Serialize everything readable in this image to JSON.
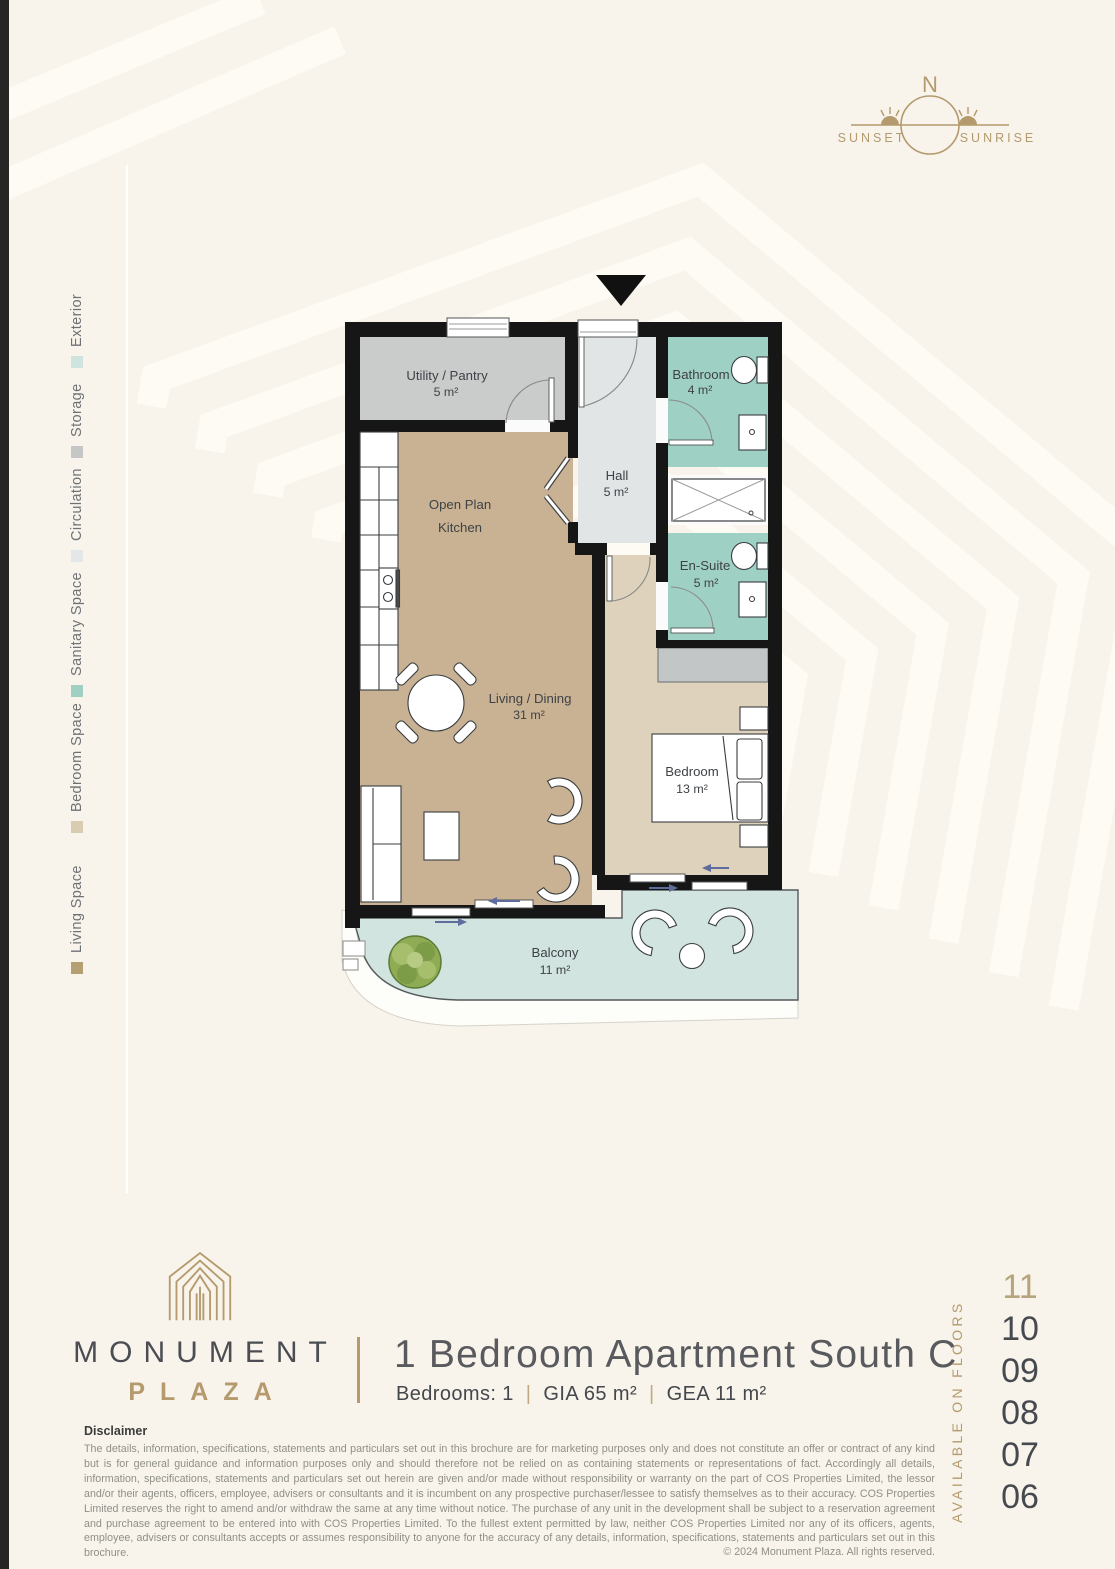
{
  "page": {
    "background": "#f8f4ec",
    "accent_gold": "#b49a6c",
    "edge_strip_color": "#262624"
  },
  "compass": {
    "north": "N",
    "sunset": "SUNSET",
    "sunrise": "SUNRISE"
  },
  "legend": {
    "items": [
      {
        "label": "Living Space",
        "color": "#b4a073"
      },
      {
        "label": "Bedroom Space",
        "color": "#d8ccb2"
      },
      {
        "label": "Sanitary Space",
        "color": "#a0cfc4"
      },
      {
        "label": "Circulation",
        "color": "#e3e7e8"
      },
      {
        "label": "Storage",
        "color": "#c5c7c6"
      },
      {
        "label": "Exterior",
        "color": "#cfe3df"
      }
    ]
  },
  "floorplan": {
    "room_fills": {
      "living": "#c9b293",
      "bedroom": "#ded2bc",
      "sanitary": "#9fd0c4",
      "circulation": "#e1e5e6",
      "storage": "#c9cccb",
      "exterior": "#d1e4e0",
      "wardrobe": "#c3c6c6",
      "shower": "#fafbfa"
    },
    "rooms": {
      "utility": {
        "name": "Utility / Pantry",
        "area": "5 m²"
      },
      "kitchen": {
        "name_line1": "Open Plan",
        "name_line2": "Kitchen"
      },
      "hall": {
        "name": "Hall",
        "area": "5 m²"
      },
      "bathroom": {
        "name": "Bathroom",
        "area": "4 m²"
      },
      "ensuite": {
        "name": "En-Suite",
        "area": "5 m²"
      },
      "living": {
        "name": "Living / Dining",
        "area": "31 m²"
      },
      "bedroom": {
        "name": "Bedroom",
        "area": "13 m²"
      },
      "balcony": {
        "name": "Balcony",
        "area": "11 m²"
      }
    }
  },
  "footer": {
    "brand": {
      "line1": "MONUMENT",
      "line2": "PLAZA"
    },
    "unit_title": "1 Bedroom Apartment South C",
    "specs": {
      "bedrooms": "Bedrooms: 1",
      "gia": "GIA 65 m²",
      "gea": "GEA 11 m²",
      "separator": "|"
    },
    "availability": {
      "label": "AVAILABLE ON FLOORS",
      "floors": [
        "11",
        "10",
        "09",
        "08",
        "07",
        "06"
      ],
      "highlighted_floor": "11"
    },
    "disclaimer": {
      "title": "Disclaimer",
      "body": "The details, information, specifications, statements and particulars set out in this brochure are for marketing purposes only and does not constitute an offer or contract of any kind but is for general guidance and information purposes only and should therefore not be relied on as containing statements or representations of fact. Accordingly all details, information, specifications, statements and particulars set out herein are given and/or made without responsibility or warranty on the part of COS Properties Limited, the lessor and/or their agents, officers, employee, advisers or consultants and it is incumbent on any prospective purchaser/lessee to satisfy themselves as to their accuracy. COS Properties Limited reserves the right to amend and/or withdraw the same at any time without notice. The purchase of any unit in the development shall be subject to a reservation agreement and purchase agreement to be entered into with COS Properties Limited. To the fullest extent permitted by law, neither COS Properties Limited nor any of its officers, agents, employee, advisers or consultants accepts or assumes responsibility to anyone for the accuracy of any details, information, specifications, statements and particulars set out in this brochure.",
      "copyright": "© 2024  Monument Plaza. All rights reserved."
    }
  }
}
